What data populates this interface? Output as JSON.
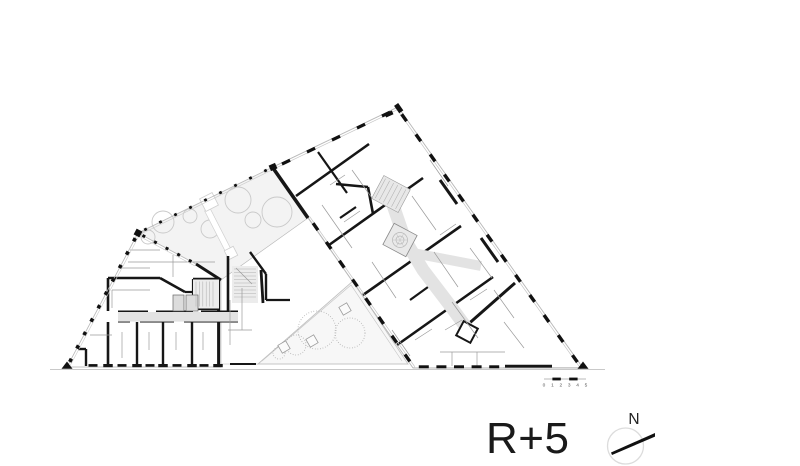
{
  "annotations": {
    "floor_label": "R+5"
  },
  "compass": {
    "label": "N",
    "icon": "north-arrow-icon"
  },
  "scale_bar": {
    "labels": [
      "0",
      "1",
      "2",
      "3",
      "4",
      "5"
    ]
  },
  "colors": {
    "ink": "#1a1a1a",
    "wall": "#161616",
    "corridor": "#e3e3e3",
    "courtyard_fill": "#f3f3f3",
    "tree_outline": "#c9c9c9"
  }
}
